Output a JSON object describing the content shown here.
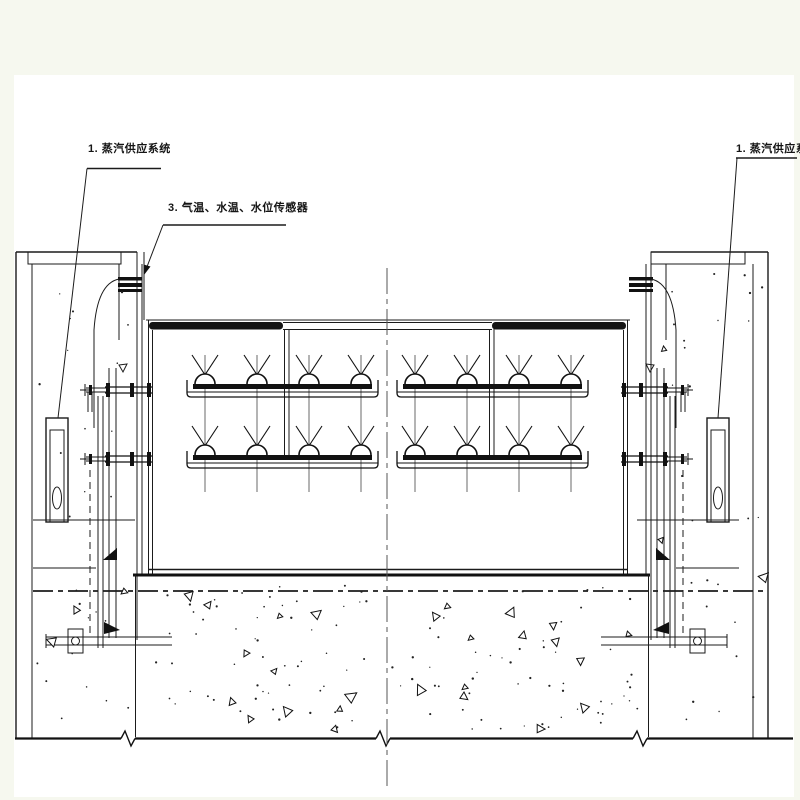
{
  "drawing": {
    "type": "engineering-cad-section",
    "colors": {
      "margin_background": "#f6f8ef",
      "paper": "#ffffff",
      "ink": "#1b1b1b"
    },
    "annotations": {
      "left_label": "1. 蒸汽供应系统",
      "middle_label": "3. 气温、水温、水位传感器",
      "right_label": "1. 蒸汽供应系统"
    }
  }
}
